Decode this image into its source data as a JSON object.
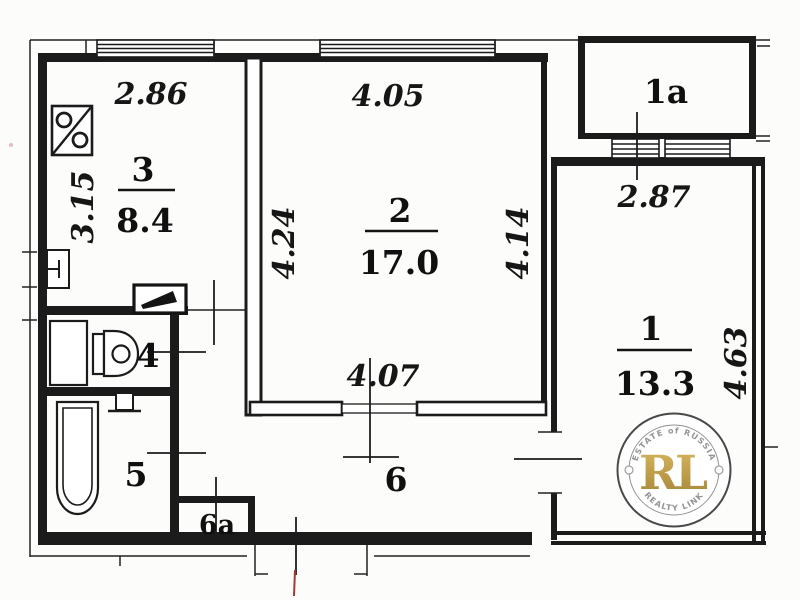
{
  "plan_title": "apartment-floor-plan",
  "rooms": {
    "kitchen": {
      "number": "3",
      "area": "8.4"
    },
    "living": {
      "number": "2",
      "area": "17.0"
    },
    "bedroom": {
      "number": "1",
      "area": "13.3"
    },
    "balcony": {
      "number": "1a"
    },
    "wc": {
      "number": "4"
    },
    "bath": {
      "number": "5"
    },
    "hall": {
      "number": "6"
    },
    "closet": {
      "number": "6a"
    }
  },
  "dimensions": {
    "kitchen_top": "2.86",
    "kitchen_left": "3.15",
    "room2_top": "4.05",
    "room2_left": "4.24",
    "room2_right": "4.14",
    "room2_bottom": "4.07",
    "room1_top": "2.87",
    "room1_right": "4.63"
  },
  "watermark": {
    "arc_top": "ESTATE of RUSSIA",
    "monogram": "RL",
    "arc_bottom": "REALTY LINK",
    "gold_color": "#bf9b3e",
    "ring_color": "#3a3a3a"
  },
  "colors": {
    "ink": "#1b1b1b",
    "background": "#fcfcfa",
    "red_mark": "#a83832"
  },
  "icons": {
    "stove": "stove-icon",
    "kitchen_sink": "kitchen-sink-icon",
    "radiator": "radiator-icon",
    "cabinet": "cabinet-icon",
    "toilet": "toilet-icon",
    "washbasin": "washbasin-icon",
    "bathtub": "bathtub-icon"
  }
}
